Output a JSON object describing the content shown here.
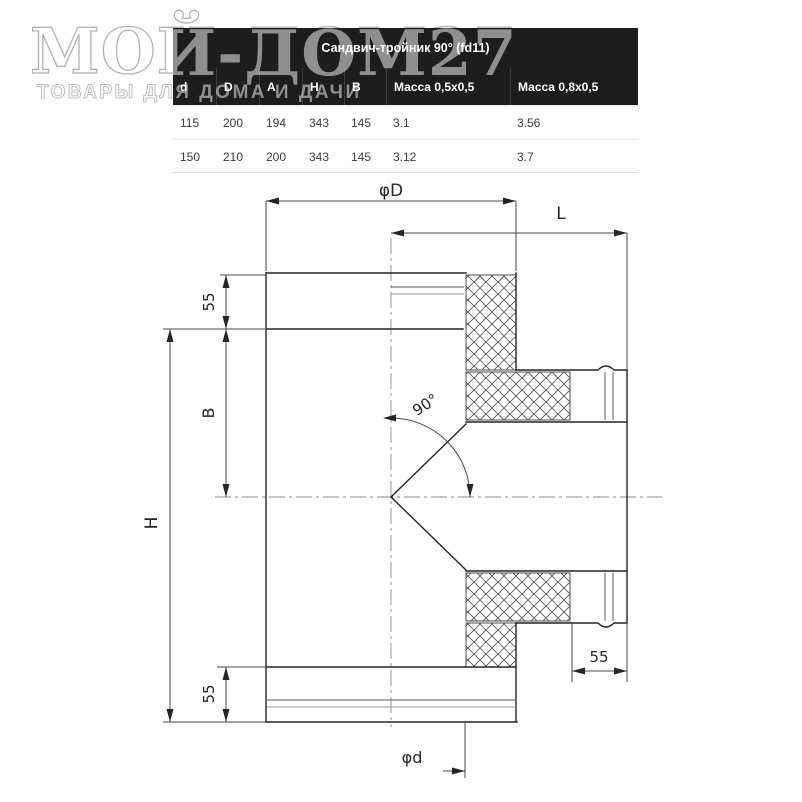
{
  "watermark": {
    "title": "МОЙ-ДОМ27",
    "subtitle": "ТОВАРЫ ДЛЯ ДОМА И ДАЧИ"
  },
  "table": {
    "title": "Сандвич-тройник 90° (fd11)",
    "columns": [
      "d",
      "D",
      "A",
      "H",
      "B",
      "Масса 0,5х0,5",
      "Масса 0,8х0,5"
    ],
    "rows": [
      [
        "115",
        "200",
        "194",
        "343",
        "145",
        "3.1",
        "3.56"
      ],
      [
        "150",
        "210",
        "200",
        "343",
        "145",
        "3.12",
        "3.7"
      ]
    ]
  },
  "drawing": {
    "labels": {
      "dia_top": "φD",
      "length": "L",
      "ins_top": "55",
      "width_b": "B",
      "height_h": "H",
      "ins_bottom": "55",
      "branch_end": "55",
      "dia_bottom": "φd",
      "angle": "90°"
    }
  },
  "colors": {
    "table_header_bg": "#1d1d1d",
    "table_header_text": "#ffffff",
    "table_row_text": "#3c3c3c",
    "watermark_gray": "#8f8f8f",
    "drawing_line": "#252525"
  }
}
